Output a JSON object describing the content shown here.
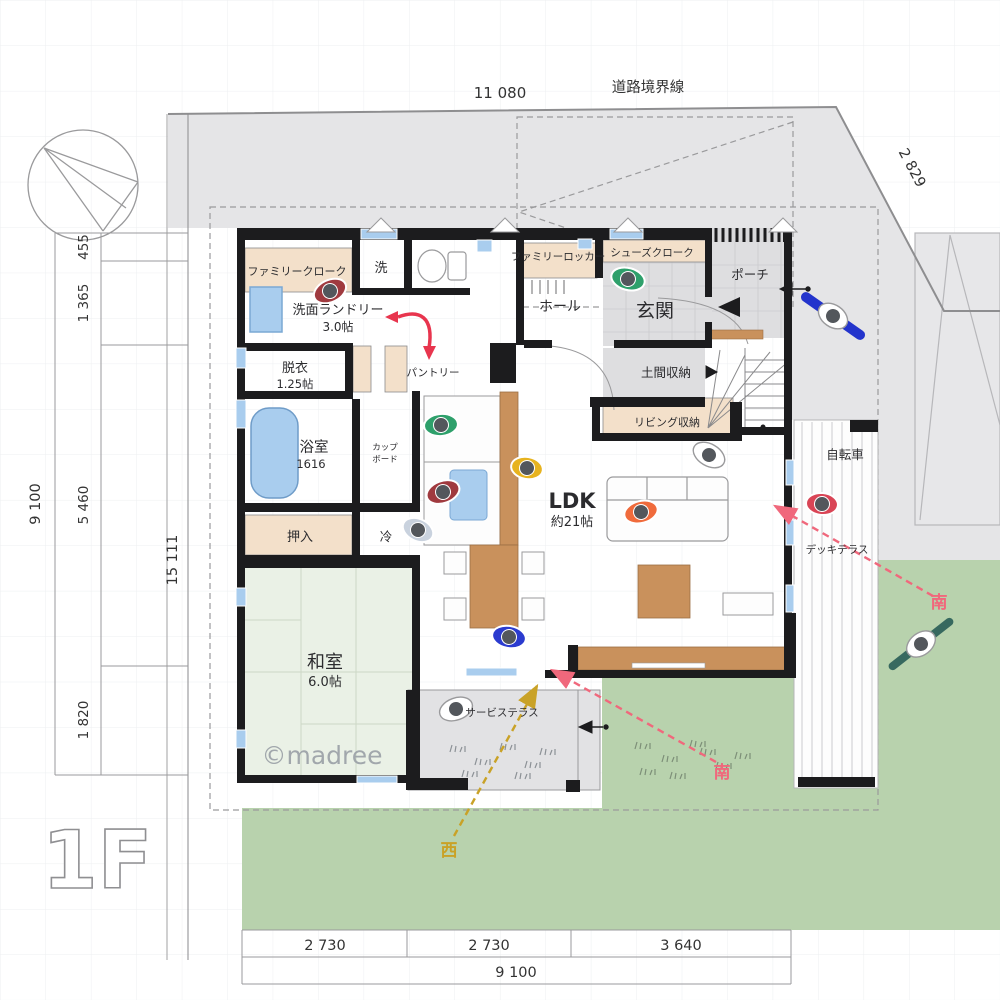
{
  "plan": {
    "floor_label": "1F",
    "watermark": "©madree",
    "site": {
      "road_boundary_label": "道路境界線",
      "compass_icon": "north-arrow-compass"
    },
    "dimensions": {
      "top_width": "11 080",
      "right_diagonal": "2 829",
      "left_total": "9 100",
      "left_segments": [
        "455",
        "1 365",
        "5 460",
        "1 820"
      ],
      "site_height_total": "15 111",
      "bottom_segments": [
        "2 730",
        "2 730",
        "3 640"
      ],
      "bottom_total": "9 100"
    },
    "rooms": {
      "family_cloak": {
        "name": "ファミリークローク"
      },
      "laundry_room": {
        "name": "洗"
      },
      "washroom": {
        "name": "洗面ランドリー",
        "size": "3.0帖"
      },
      "dressing": {
        "name": "脱衣",
        "size": "1.25帖"
      },
      "pantry": {
        "name": "パントリー"
      },
      "family_locker": {
        "name": "ファミリーロッカー"
      },
      "shoes_cloak": {
        "name": "シューズクローク"
      },
      "hall": {
        "name": "ホール"
      },
      "entrance": {
        "name": "玄関"
      },
      "porch": {
        "name": "ポーチ"
      },
      "doma_storage": {
        "name": "土間収納"
      },
      "living_storage": {
        "name": "リビング収納"
      },
      "bicycle_area": {
        "name": "自転車"
      },
      "bathroom": {
        "name": "浴室",
        "size": "1616"
      },
      "cupboard": {
        "line1": "カップ",
        "line2": "ボード"
      },
      "closet": {
        "name": "押入"
      },
      "fridge": {
        "name": "冷"
      },
      "japanese_room": {
        "name": "和室",
        "size": "6.0帖"
      },
      "ldk": {
        "name": "LDK",
        "size": "約21帖"
      },
      "deck_terrace": {
        "name": "デッキテラス"
      },
      "service_terrace": {
        "name": "サービステラス"
      }
    },
    "annotations": {
      "south_garden": "南",
      "south_terrace": "南",
      "west": "西"
    },
    "colors": {
      "wall": "#1c1c1e",
      "pavement": "#e5e5e7",
      "tile": "#dedee0",
      "garden": "#b8d2ad",
      "tatami": "#eaf1e6",
      "closet_beige": "#f3e0ca",
      "wood": "#c9915c",
      "water_blue": "#a9cdee",
      "flow_red": "#e8354e",
      "south_pink": "#f0687c",
      "west_yellow": "#c9a227"
    }
  }
}
